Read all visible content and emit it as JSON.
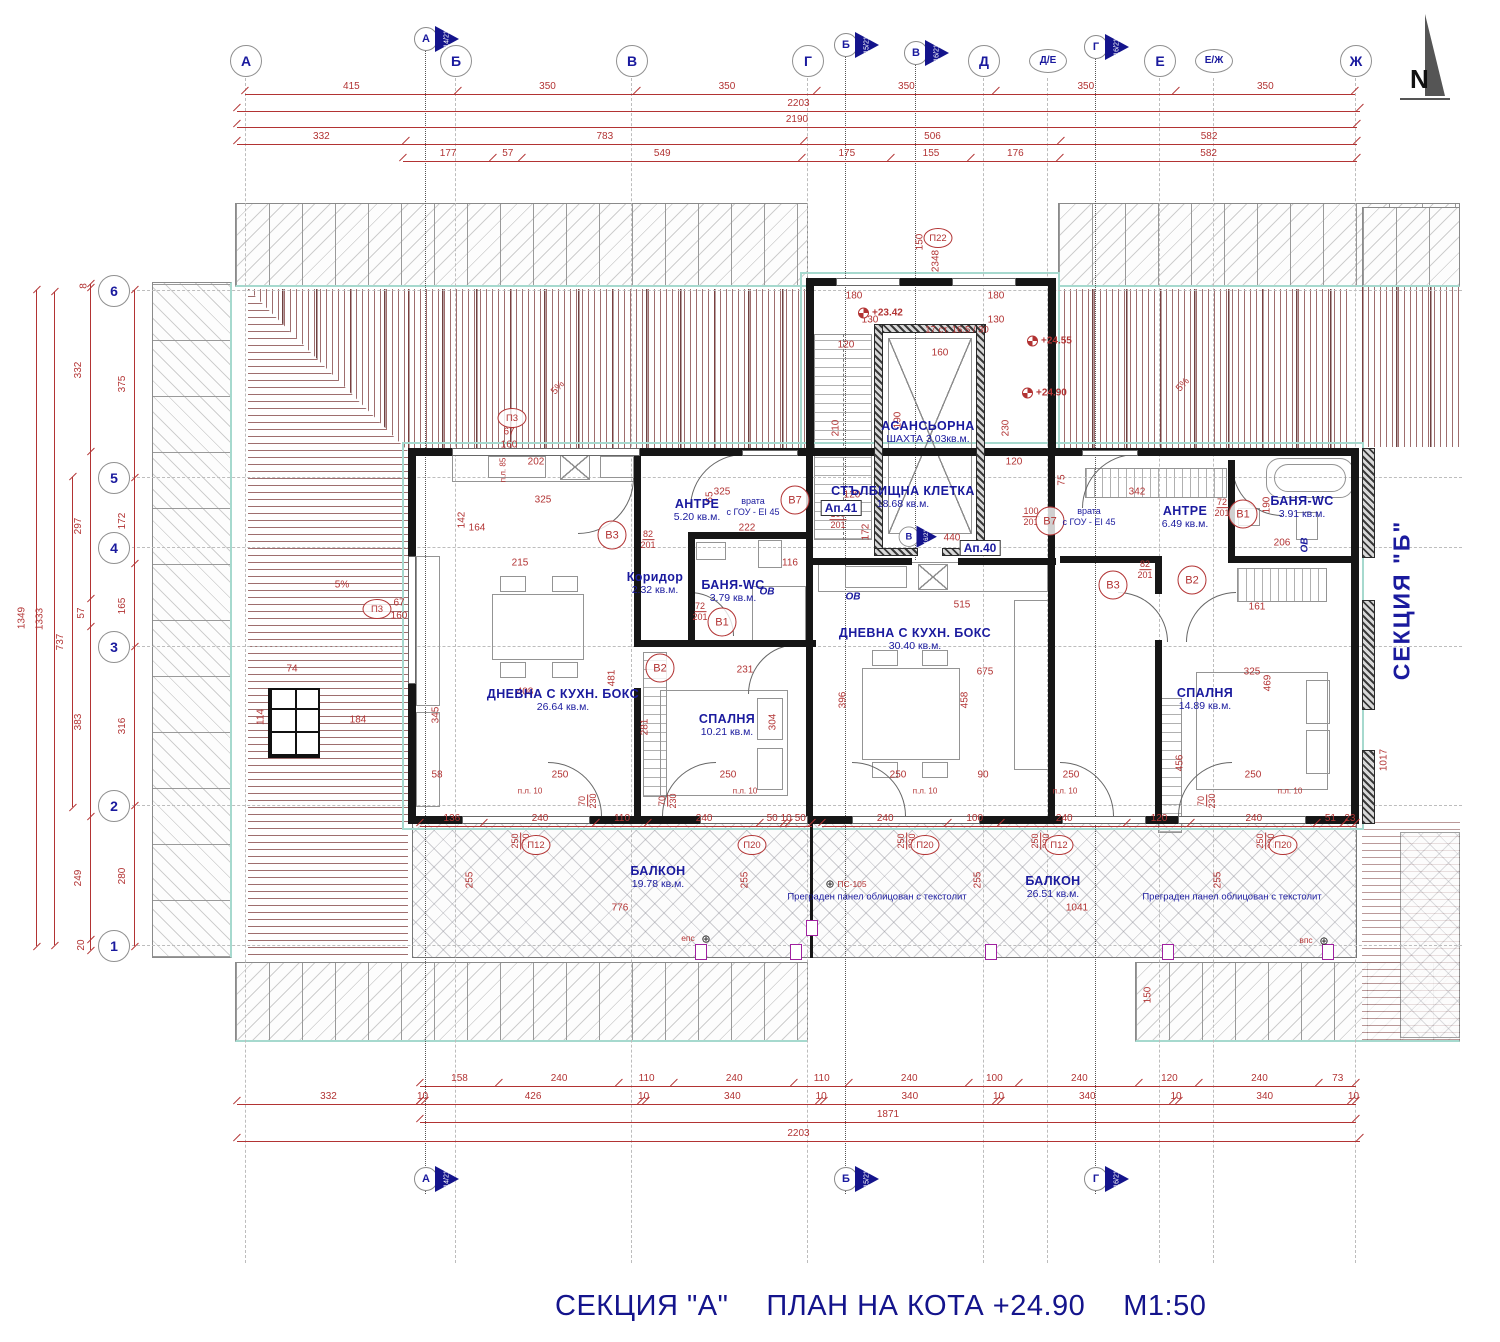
{
  "title": {
    "section": "СЕКЦИЯ \"А\"",
    "plan": "ПЛАН НА КОТА +24.90",
    "scale": "М1:50"
  },
  "side_label": "СЕКЦИЯ  \"Б\"",
  "north": "N",
  "grid": {
    "top": [
      "А",
      "Б",
      "В",
      "Г",
      "Д",
      "Д/Е",
      "Е",
      "Е/Ж",
      "Ж"
    ],
    "left": [
      "6",
      "5",
      "4",
      "3",
      "2",
      "1"
    ]
  },
  "flags": {
    "top": [
      {
        "l": "А",
        "ref": "14/21"
      },
      {
        "l": "Б",
        "ref": "15/21"
      },
      {
        "l": "В",
        "ref": "16/21"
      },
      {
        "l": "Г",
        "ref": "16/21"
      }
    ],
    "mid": {
      "l": "В",
      "ref": "16/21"
    },
    "bottom": [
      {
        "l": "А",
        "ref": "14/21"
      },
      {
        "l": "Б",
        "ref": "15/21"
      },
      {
        "l": "Г",
        "ref": "16/21"
      }
    ]
  },
  "dims": {
    "top1": [
      415,
      350,
      350,
      350,
      350,
      350
    ],
    "top_total": "2203",
    "top_total2": "2190",
    "top2": [
      332,
      783,
      506,
      582
    ],
    "top3": [
      177,
      57,
      549,
      175,
      155,
      176,
      582
    ],
    "left_total": "1349",
    "left_total2": "1333",
    "left_mid": "737",
    "left1": [
      8,
      332,
      297,
      57,
      383,
      249,
      20
    ],
    "left2": [
      375,
      172,
      165,
      316,
      280
    ],
    "bottom1": [
      158,
      240,
      110,
      240,
      110,
      240,
      100,
      240,
      120,
      240,
      73
    ],
    "bottom2": [
      10,
      426,
      10,
      340,
      10,
      340,
      10,
      340,
      10,
      340,
      10
    ],
    "bottom_total": "1871",
    "bottom_left": "332",
    "bottom_total2": "2203",
    "balcony_left": [
      136,
      240,
      110,
      240,
      50,
      10,
      50
    ],
    "balcony_right": [
      240,
      100,
      240,
      120,
      240,
      51,
      23
    ]
  },
  "rooms": [
    {
      "id": "antre-l",
      "name": "АНТРЕ",
      "area": "5.20 кв.м."
    },
    {
      "id": "koridor",
      "name": "Коридор",
      "area": "2.32 кв.м."
    },
    {
      "id": "bania-l",
      "name": "БАНЯ-WC",
      "area": "3.79 кв.м."
    },
    {
      "id": "dnevna-l",
      "name": "ДНЕВНА  С  КУХН. БОКС",
      "area": "26.64 кв.м."
    },
    {
      "id": "spalnia-l",
      "name": "СПАЛНЯ",
      "area": "10.21 кв.м."
    },
    {
      "id": "stair",
      "name": "СТЪЛБИЩНА  КЛЕТКА",
      "area": "18.68 кв.м."
    },
    {
      "id": "lift",
      "name": "АСАНСЬОРНА",
      "area": "ШАХТА 3.03кв.м."
    },
    {
      "id": "dnevna-m",
      "name": "ДНЕВНА  С  КУХН. БОКС",
      "area": "30.40 кв.м."
    },
    {
      "id": "antre-r",
      "name": "АНТРЕ",
      "area": "6.49 кв.м."
    },
    {
      "id": "bania-r",
      "name": "БАНЯ-WC",
      "area": "3.91 кв.м."
    },
    {
      "id": "spalnia-r",
      "name": "СПАЛНЯ",
      "area": "14.89 кв.м."
    },
    {
      "id": "balkon-l",
      "name": "БАЛКОН",
      "area": "19.78 кв.м."
    },
    {
      "id": "balkon-r",
      "name": "БАЛКОН",
      "area": "26.51 кв.м."
    }
  ],
  "apartments": [
    "Ап.41",
    "Ап.40"
  ],
  "annotations": {
    "door_note": [
      "врата",
      "с ГОУ - EI 45"
    ],
    "panel_note": "Преграден панел облицован с текстолит",
    "stair_note": "17 ст. 16.5 / 30",
    "levels": [
      "+23.42",
      "+24.55",
      "+24.90"
    ],
    "slope": "5%",
    "ov": "ОВ",
    "eps": "епс",
    "vps": "впс",
    "ps": "ПС-105",
    "pl": "п.л. 10",
    "pl85": "п.л. 85",
    "sym": "⊕"
  },
  "markers": [
    "В3",
    "В1",
    "В2",
    "В7",
    "В7",
    "В3",
    "В2",
    "В1",
    "П3",
    "П3",
    "П12",
    "П20",
    "П20",
    "П12",
    "П20",
    "П22"
  ],
  "scatter": [
    [
      "150",
      920,
      242,
      -90
    ],
    [
      "2348",
      936,
      261,
      -90
    ],
    [
      "180",
      854,
      296,
      0
    ],
    [
      "130",
      870,
      320,
      0
    ],
    [
      "120",
      846,
      345,
      0
    ],
    [
      "160",
      940,
      353,
      0
    ],
    [
      "180",
      996,
      296,
      0
    ],
    [
      "130",
      996,
      320,
      0
    ],
    [
      "190",
      898,
      420,
      -90
    ],
    [
      "210",
      836,
      428,
      -90
    ],
    [
      "230",
      1006,
      428,
      -90
    ],
    [
      "120",
      1014,
      462,
      0
    ],
    [
      "440",
      952,
      538,
      0
    ],
    [
      "172",
      866,
      532,
      -90
    ],
    [
      "120",
      852,
      495,
      0
    ],
    [
      "325",
      543,
      500,
      0
    ],
    [
      "202",
      536,
      462,
      0
    ],
    [
      "164",
      477,
      528,
      0
    ],
    [
      "142",
      462,
      520,
      -90
    ],
    [
      "215",
      520,
      563,
      0
    ],
    [
      "116",
      790,
      563,
      0
    ],
    [
      "222",
      747,
      528,
      0
    ],
    [
      "325",
      722,
      492,
      0
    ],
    [
      "65",
      710,
      497,
      -90
    ],
    [
      "515",
      962,
      605,
      0
    ],
    [
      "675",
      985,
      672,
      0
    ],
    [
      "458",
      965,
      700,
      -90
    ],
    [
      "396",
      843,
      700,
      -90
    ],
    [
      "408",
      525,
      692,
      0
    ],
    [
      "481",
      612,
      678,
      -90
    ],
    [
      "231",
      745,
      670,
      0
    ],
    [
      "304",
      773,
      722,
      -90
    ],
    [
      "281",
      645,
      727,
      -90
    ],
    [
      "345",
      436,
      715,
      -90
    ],
    [
      "250",
      560,
      775,
      0
    ],
    [
      "58",
      437,
      775,
      0
    ],
    [
      "250",
      728,
      775,
      0
    ],
    [
      "250",
      898,
      775,
      0
    ],
    [
      "90",
      983,
      775,
      0
    ],
    [
      "250",
      1071,
      775,
      0
    ],
    [
      "250",
      1253,
      775,
      0
    ],
    [
      "325",
      1252,
      672,
      0
    ],
    [
      "469",
      1268,
      683,
      -90
    ],
    [
      "456",
      1180,
      763,
      -90
    ],
    [
      "161",
      1257,
      607,
      0
    ],
    [
      "206",
      1282,
      543,
      0
    ],
    [
      "190",
      1267,
      505,
      -90
    ],
    [
      "342",
      1137,
      492,
      0
    ],
    [
      "75",
      1062,
      480,
      -90
    ],
    [
      "255",
      470,
      880,
      -90
    ],
    [
      "255",
      745,
      880,
      -90
    ],
    [
      "255",
      978,
      880,
      -90
    ],
    [
      "255",
      1218,
      880,
      -90
    ],
    [
      "776",
      620,
      908,
      0
    ],
    [
      "1041",
      1077,
      908,
      0
    ],
    [
      "1017",
      1384,
      760,
      -90
    ],
    [
      "150",
      1148,
      995,
      -90
    ],
    [
      "74",
      292,
      669,
      0
    ],
    [
      "114",
      261,
      717,
      -90
    ],
    [
      "184",
      358,
      720,
      0
    ],
    [
      "67",
      399,
      603,
      0
    ],
    [
      "160",
      399,
      616,
      0
    ],
    [
      "67",
      509,
      432,
      0
    ],
    [
      "160",
      509,
      445,
      0
    ]
  ],
  "fracs": [
    [
      "82",
      "201",
      648,
      540,
      0
    ],
    [
      "72",
      "201",
      700,
      612,
      0
    ],
    [
      "72",
      "201",
      1222,
      508,
      0
    ],
    [
      "100",
      "201",
      838,
      520,
      0
    ],
    [
      "100",
      "201",
      1031,
      517,
      0
    ],
    [
      "82",
      "201",
      1145,
      570,
      0
    ],
    [
      "70",
      "230",
      588,
      801,
      -90
    ],
    [
      "70",
      "230",
      668,
      801,
      -90
    ],
    [
      "70",
      "230",
      1207,
      801,
      -90
    ],
    [
      "250",
      "230",
      521,
      841,
      -90
    ],
    [
      "250",
      "230",
      907,
      841,
      -90
    ],
    [
      "250",
      "230",
      1041,
      841,
      -90
    ],
    [
      "250",
      "230",
      1266,
      841,
      -90
    ]
  ]
}
